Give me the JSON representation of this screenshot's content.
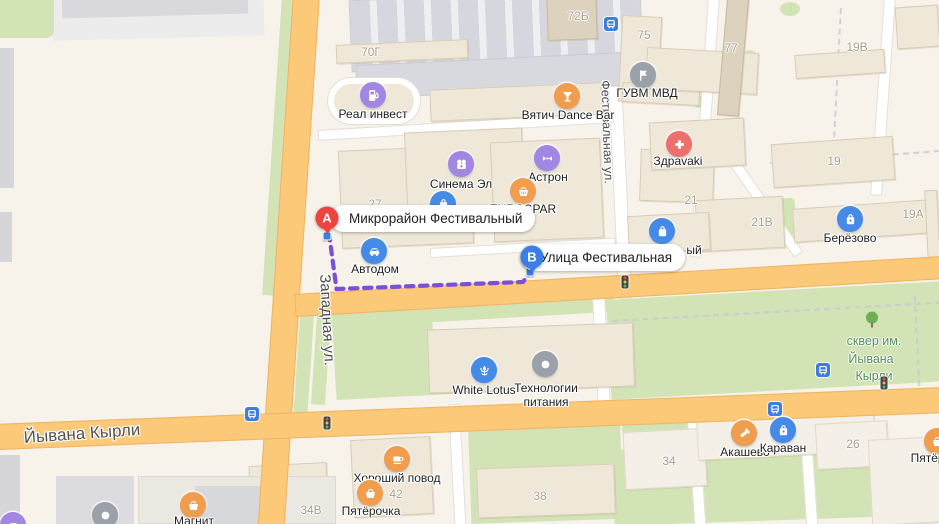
{
  "map": {
    "route": {
      "marker_a": {
        "letter": "A",
        "label": "Микрорайон Фестивальный"
      },
      "marker_b": {
        "letter": "B",
        "label": "Улица Фестивальная"
      }
    },
    "streets": {
      "zapadnaya": "Западная ул.",
      "festivalnaya": "Фестивальная ул.",
      "yyvana_kyrli": "Йывана Кырли"
    },
    "park_label": {
      "line1": "сквер им.",
      "line2": "Йывана",
      "line3": "Кырли"
    },
    "pois": {
      "real_invest": "Реал инвест",
      "vyatich_dance_bar": "Вятич Dance Bar",
      "guvm_mvd": "ГУВМ МВД",
      "zdravaki": "Здраvaki",
      "cinema_el": "Синема Эл",
      "astron": "Астрон",
      "eurospar": "EUROSPAR",
      "avtodom": "Автодом",
      "berezovo": "Берёзово",
      "white_lotus": "White Lotus",
      "tehnologii_pitaniya": "Технологии питания",
      "horoshiy_povod": "Хороший повод",
      "pyaterochka": "Пятёрочка",
      "magnit": "Магнит",
      "akashevo": "Акашево",
      "karavan": "Караван",
      "hidden_label_fragment": "ый"
    },
    "building_numbers": {
      "b70g": "70Г",
      "b72b": "72Б",
      "b75": "75",
      "b77": "77",
      "b19v": "19В",
      "b19": "19",
      "b21": "21",
      "b21v": "21В",
      "b19a": "19А",
      "b27": "27",
      "b34v": "34В",
      "b42": "42",
      "b38": "38",
      "b34": "34",
      "b26": "26"
    },
    "colors": {
      "route_purple": "#7c4fd9",
      "road_orange": "#fbc978",
      "park_green": "#d2e4b5",
      "marker_a_red": "#ee4440",
      "marker_b_blue": "#3b7ee8",
      "poi_blue": "#458ae6",
      "poi_orange": "#f09d4e",
      "poi_purple": "#a287e2"
    }
  }
}
